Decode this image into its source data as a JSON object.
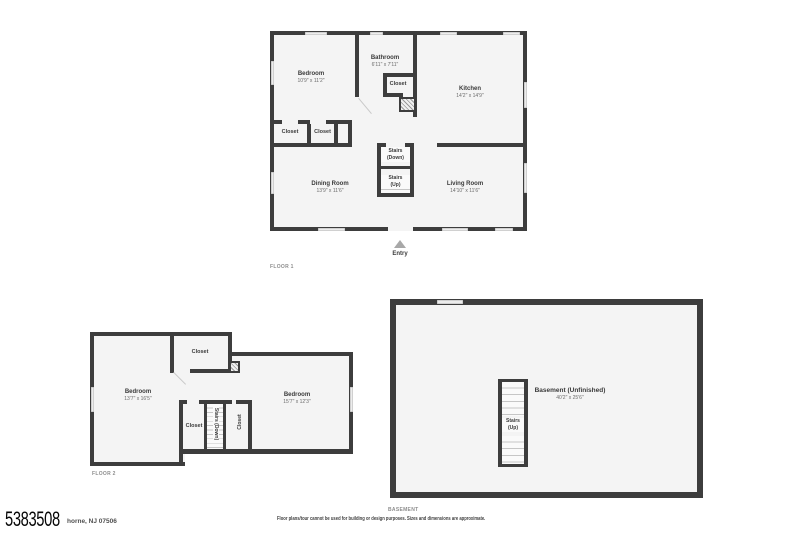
{
  "colors": {
    "wall": "#3d3d3d",
    "floor_fill": "#f4f4f4",
    "background": "#ffffff",
    "room_name_text": "#3a3a3a",
    "dimension_text": "#6b6b6b",
    "floor_tag_text": "#8d8d8d",
    "entry_arrow": "#a8a8a8"
  },
  "floor1": {
    "label": "FLOOR 1",
    "entry": "Entry",
    "rooms": {
      "bedroom": {
        "name": "Bedroom",
        "dims": "10'9\" x 11'2\""
      },
      "bathroom": {
        "name": "Bathroom",
        "dims": "6'11\" x 7'11\""
      },
      "bath_closet": {
        "name": "Closet"
      },
      "kitchen": {
        "name": "Kitchen",
        "dims": "14'2\" x 14'9\""
      },
      "closet_a": {
        "name": "Closet"
      },
      "closet_b": {
        "name": "Closet"
      },
      "stairs_down": {
        "line1": "Stairs",
        "line2": "(Down)"
      },
      "stairs_up": {
        "line1": "Stairs",
        "line2": "(Up)"
      },
      "dining": {
        "name": "Dining Room",
        "dims": "13'9\" x 11'6\""
      },
      "living": {
        "name": "Living Room",
        "dims": "14'10\" x 11'6\""
      }
    }
  },
  "floor2": {
    "label": "FLOOR 2",
    "rooms": {
      "closet_top": {
        "name": "Closet"
      },
      "bedroom_left": {
        "name": "Bedroom",
        "dims": "13'7\" x 16'5\""
      },
      "bedroom_right": {
        "name": "Bedroom",
        "dims": "15'7\" x 12'3\""
      },
      "closet_bottom": {
        "name": "Closet"
      },
      "stairs_down": {
        "name": "Stairs (Down)"
      },
      "closet_side": {
        "name": "Closet"
      }
    }
  },
  "basement": {
    "label": "BASEMENT",
    "rooms": {
      "main": {
        "name": "Basement (Unfinished)",
        "dims": "40'2\" x 25'6\""
      },
      "stairs_up": {
        "line1": "Stairs",
        "line2": "(Up)"
      }
    }
  },
  "footer": {
    "listing_number": "5383508",
    "address": "horne, NJ 07506",
    "disclaimer": "Floor plans/tour cannot be used for building or design purposes. Sizes and dimensions are approximate."
  }
}
